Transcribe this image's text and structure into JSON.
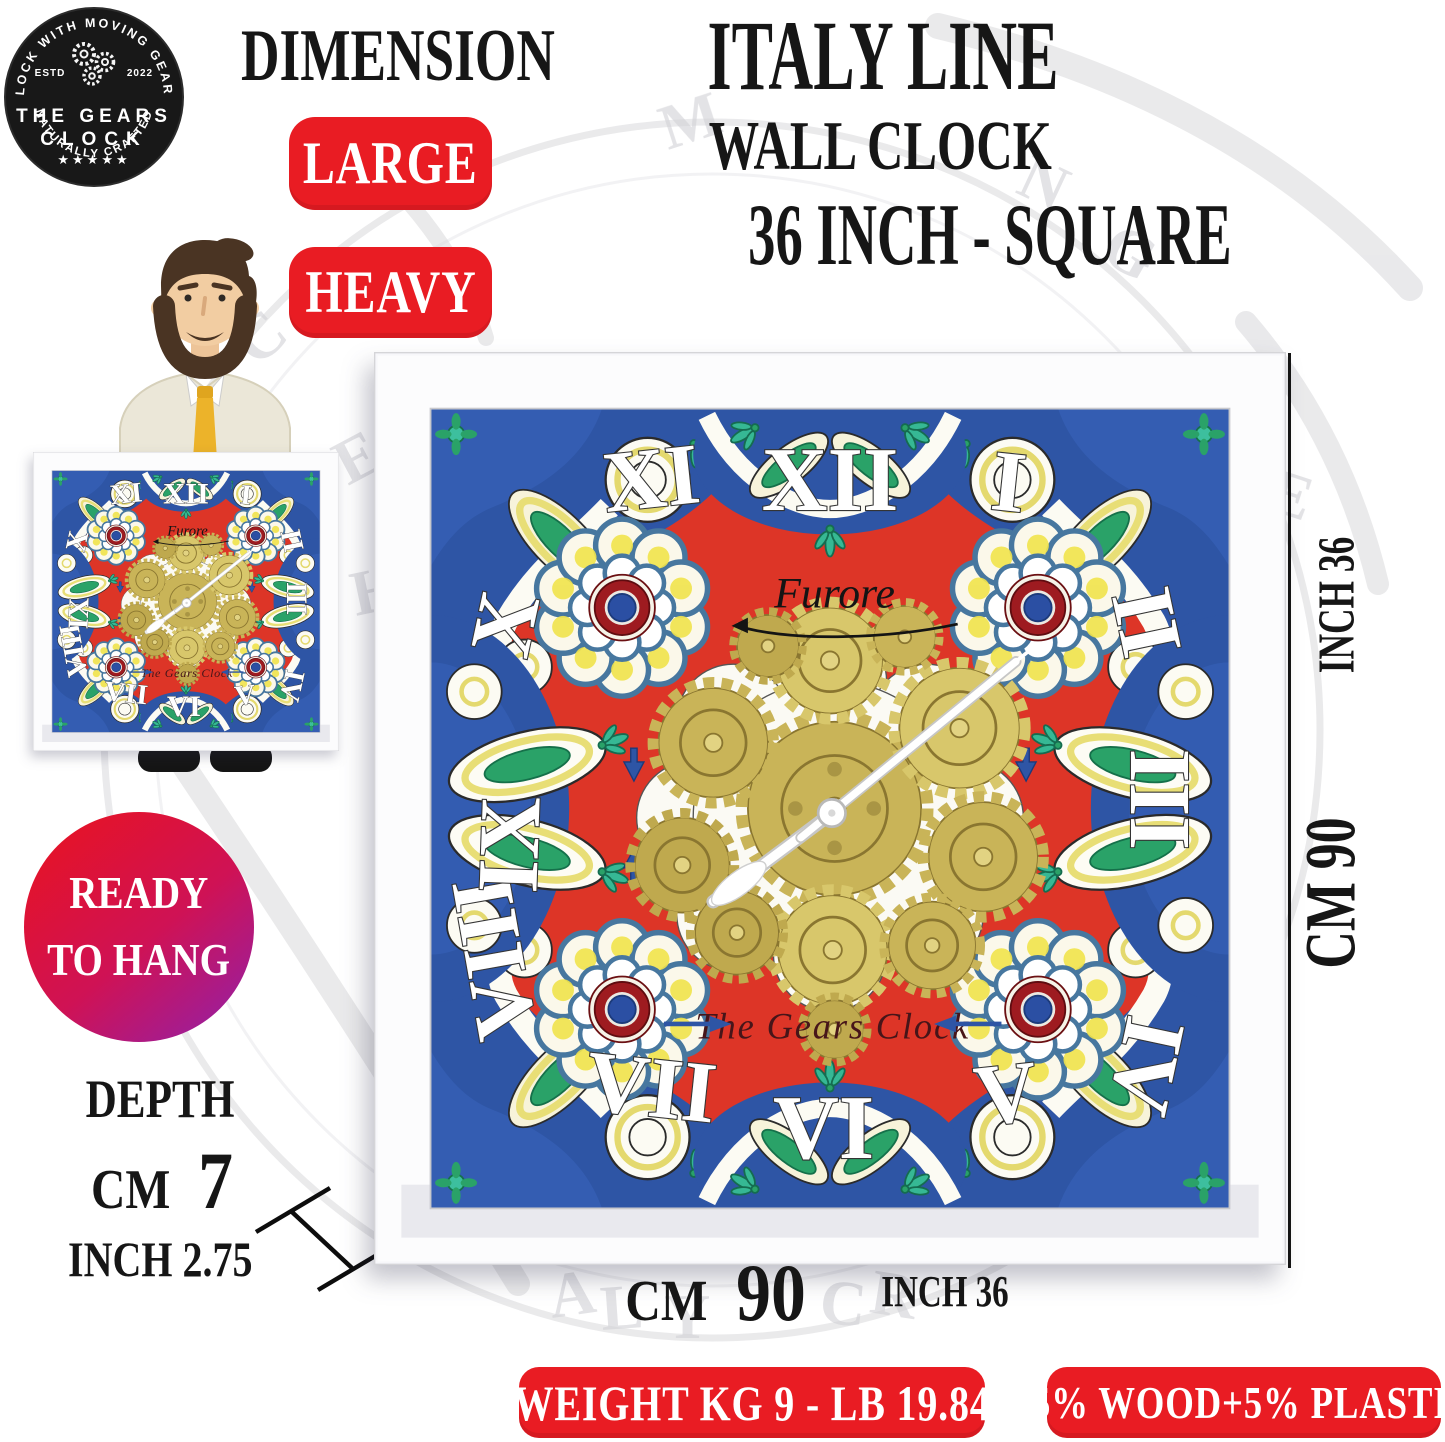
{
  "brand_badge": {
    "arc_top": "CLOCK WITH MOVING GEARS",
    "estd": "ESTD",
    "year": "2022",
    "name_line1": "THE GEARS",
    "name_line2": "CLOCK",
    "stars": "★★★★★",
    "arc_bottom": "NATURALLY CRAFTED"
  },
  "header": {
    "dimension": "DIMENSION",
    "size_badges": [
      {
        "label": "LARGE"
      },
      {
        "label": "HEAVY"
      }
    ]
  },
  "title": {
    "line1": "ITALY LINE",
    "line2": "WALL CLOCK",
    "line3": "36 INCH - SQUARE"
  },
  "clock_face": {
    "brand": "Furore",
    "maker": "The Gears Clock",
    "numerals": [
      "XII",
      "I",
      "II",
      "III",
      "IV",
      "V",
      "VI",
      "VII",
      "VIII",
      "IX",
      "X",
      "XI"
    ]
  },
  "dimension_labels": {
    "right_inch": "INCH 36",
    "right_cm": "CM 90",
    "bottom_cm_unit": "CM",
    "bottom_cm_value": "90",
    "bottom_inch": "INCH 36"
  },
  "depth": {
    "label": "DEPTH",
    "cm_unit": "CM",
    "cm_value": "7",
    "inch": "INCH 2.75"
  },
  "ready_badge": {
    "line1": "READY",
    "line2": "TO HANG"
  },
  "footer_badges": [
    {
      "label": "WEIGHT KG 9 - LB 19.84"
    },
    {
      "label": "95% WOOD+5% PLASTIC"
    }
  ],
  "colors": {
    "badge_red": "#e91c23",
    "logo_black": "#181818",
    "ready_gradient_start": "#e61325",
    "ready_gradient_end": "#8f21ad",
    "face_red": "#dd3527",
    "face_blue": "#2e55a5",
    "gear_gold": "#c9b458",
    "frame_white": "#f7f7fa"
  }
}
